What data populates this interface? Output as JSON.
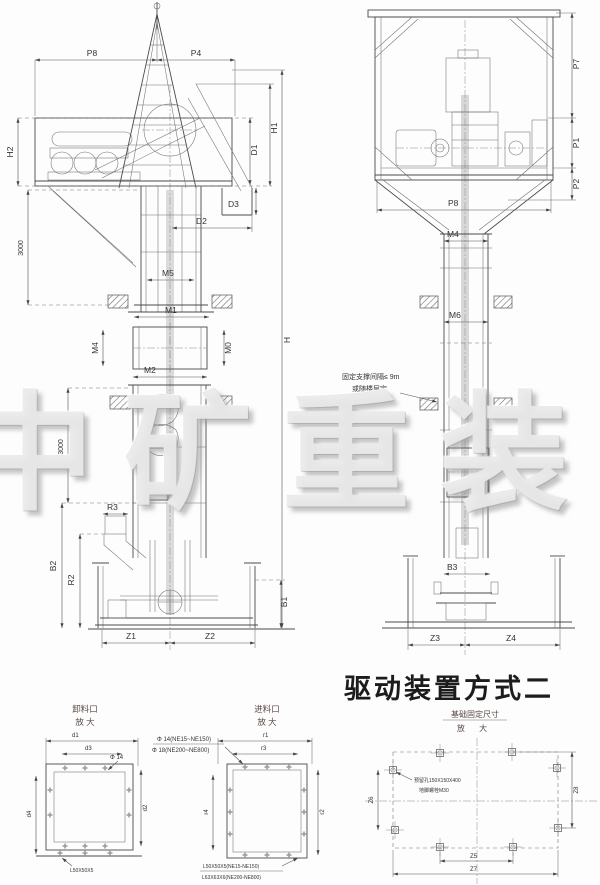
{
  "watermark": "中矿重装",
  "title": "驱动装置方式二",
  "left_view": {
    "dims": {
      "p8": "P8",
      "p4": "P4",
      "h1": "H1",
      "h2": "H2",
      "d1": "D1",
      "d3": "D3",
      "d2": "D2",
      "m5": "M5",
      "dim3000_upper": "3000",
      "m1": "M1",
      "m4": "M4",
      "m0": "M0",
      "m2": "M2",
      "h": "H",
      "dim3000_lower": "3000",
      "r1": "R1",
      "r3": "R3",
      "b2": "B2",
      "r2": "R2",
      "b1": "B1",
      "z1": "Z1",
      "z2": "Z2"
    }
  },
  "right_view": {
    "dims": {
      "p7": "P7",
      "p1": "P1",
      "p2": "P2",
      "p8": "P8",
      "m4": "M4",
      "m6": "M6",
      "b3": "B3",
      "z3": "Z3",
      "z4": "Z4"
    },
    "support_note": {
      "line1": "固定支撑间隔≤ 9m",
      "line2": "或随楼层定"
    }
  },
  "details": {
    "discharge": {
      "title": "卸料口",
      "subtitle": "放 大",
      "dims": {
        "d1": "d1",
        "d3": "d3",
        "d4": "d4",
        "d2": "d2"
      },
      "hole_label": "Φ 14",
      "angle_note": "L50X50X5"
    },
    "hole_note": {
      "line1": "Φ 14(NE15~NE150)",
      "line2": "Φ 18(NE200~NE800)"
    },
    "feed": {
      "title": "进料口",
      "subtitle": "放 大",
      "dims": {
        "r1": "r1",
        "r3": "r3",
        "r4": "r4",
        "r2": "r2"
      },
      "note_line1": "L50X50X5(NE15-NE150)",
      "note_line2": "L63X63X6(NE200-NE800)"
    },
    "foundation": {
      "title": "基础固定尺寸",
      "subtitle": "放 大",
      "dims": {
        "z6": "Z6",
        "z5": "Z5",
        "z7": "Z7",
        "z8": "Z8"
      },
      "note_line1": "预留孔150X150X400",
      "note_line2": "地脚螺栓M30"
    }
  }
}
